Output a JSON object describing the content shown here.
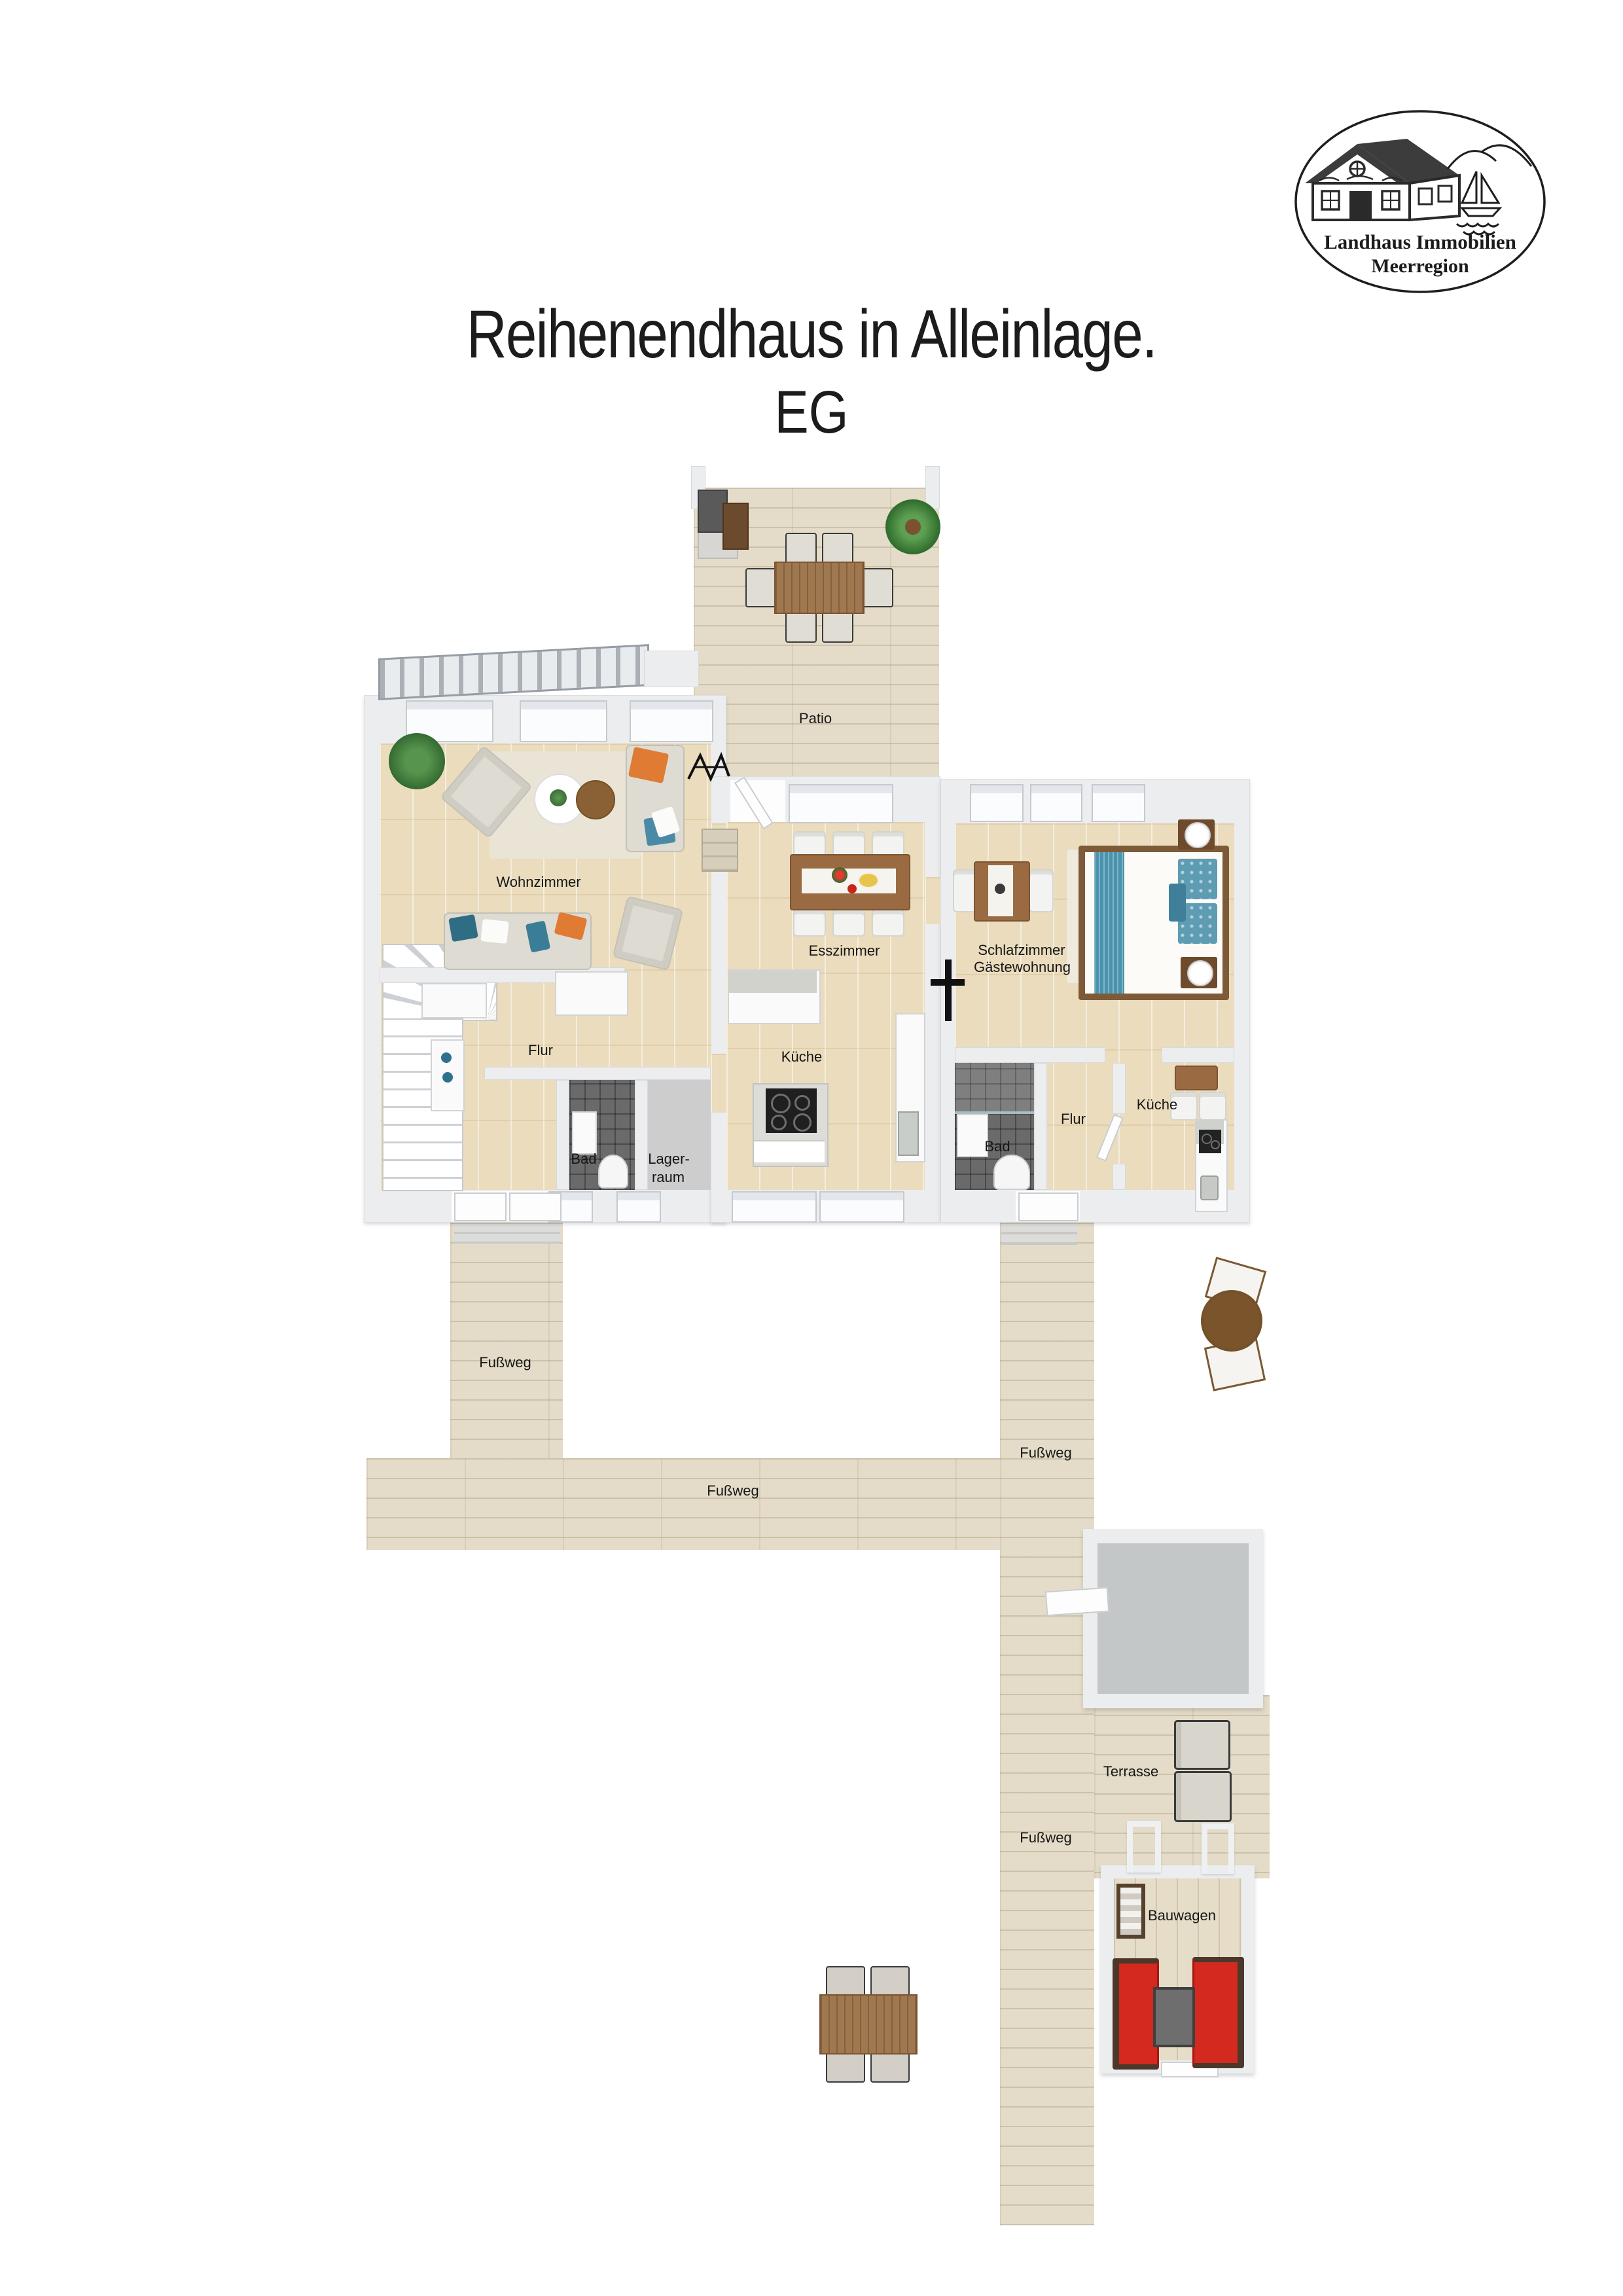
{
  "logo": {
    "line1": "Landhaus Immobilien",
    "line2": "Meerregion"
  },
  "header": {
    "title": "Reihenendhaus in Alleinlage.",
    "subtitle": "EG"
  },
  "rooms": {
    "patio": "Patio",
    "wohnzimmer": "Wohnzimmer",
    "esszimmer": "Esszimmer",
    "schlafzimmer_line1": "Schlafzimmer",
    "schlafzimmer_line2": "Gästewohnung",
    "flur_left": "Flur",
    "kueche_left": "Küche",
    "bad_left": "Bad",
    "lager_line1": "Lager-",
    "lager_line2": "raum",
    "bad_right": "Bad",
    "flur_right": "Flur",
    "kueche_right": "Küche"
  },
  "outdoor": {
    "fussweg_left": "Fußweg",
    "fussweg_bottom": "Fußweg",
    "fussweg_right_upper": "Fußweg",
    "fussweg_right_lower": "Fußweg",
    "terrasse": "Terrasse",
    "bauwagen": "Bauwagen"
  },
  "colors": {
    "wall": "#ECEDEF",
    "wood_floor": "#EADCBC",
    "deck": "#E4DCC8",
    "bath_tile": "#6A6A6A",
    "storage_floor": "#CDCDCD",
    "terrasse_floor": "#C4C7C8",
    "accent_orange": "#E07B33",
    "accent_teal": "#4B93AD",
    "sofa_red": "#D42A22",
    "wood_furniture": "#9A6B42",
    "label_text": "#161616"
  }
}
